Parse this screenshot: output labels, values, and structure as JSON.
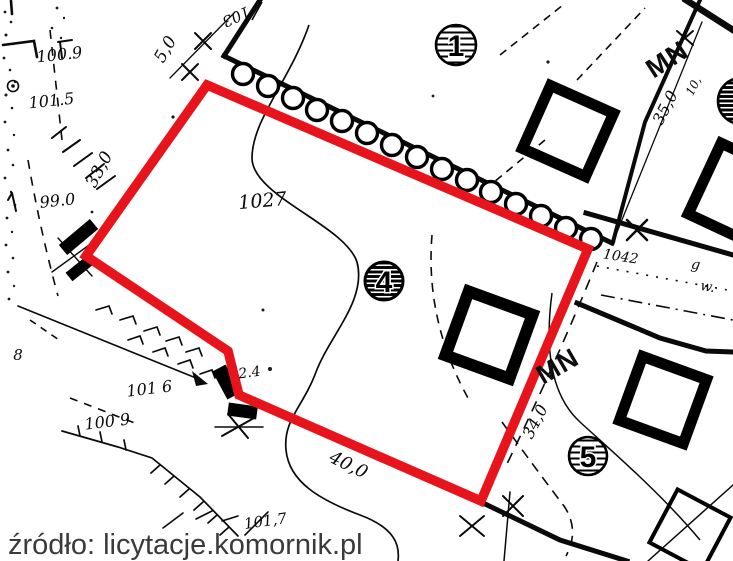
{
  "caption": {
    "source_text": "źródło: licytacje.komornik.pl"
  },
  "labels": {
    "parcel_main": "1027",
    "parcel_adjacent": "1042",
    "zone_top": "MN",
    "zone_bottom": "MN",
    "node_1": "1",
    "node_4": "4",
    "node_5": "5",
    "dim_5_0": "5,0",
    "dim_103": "103",
    "dim_33_0": "33,0",
    "dim_35_0": "35,0",
    "dim_10": "10,",
    "dim_40_0": "40,0",
    "dim_34_0": "34,0",
    "dim_2_4": "2.4",
    "elev_100_9_top": "100.9",
    "elev_101_5": "101.5",
    "elev_99_0": "99.0",
    "elev_101_6": "101 6",
    "elev_100_9_bottom": "100 9",
    "elev_101_7": "101,7",
    "digit_8": "8",
    "utility_g": "g",
    "utility_w": "w."
  },
  "colors": {
    "boundary_red": "#e8141c",
    "ink": "#0a0a0a",
    "caption_gray": "#3a3a3a"
  }
}
